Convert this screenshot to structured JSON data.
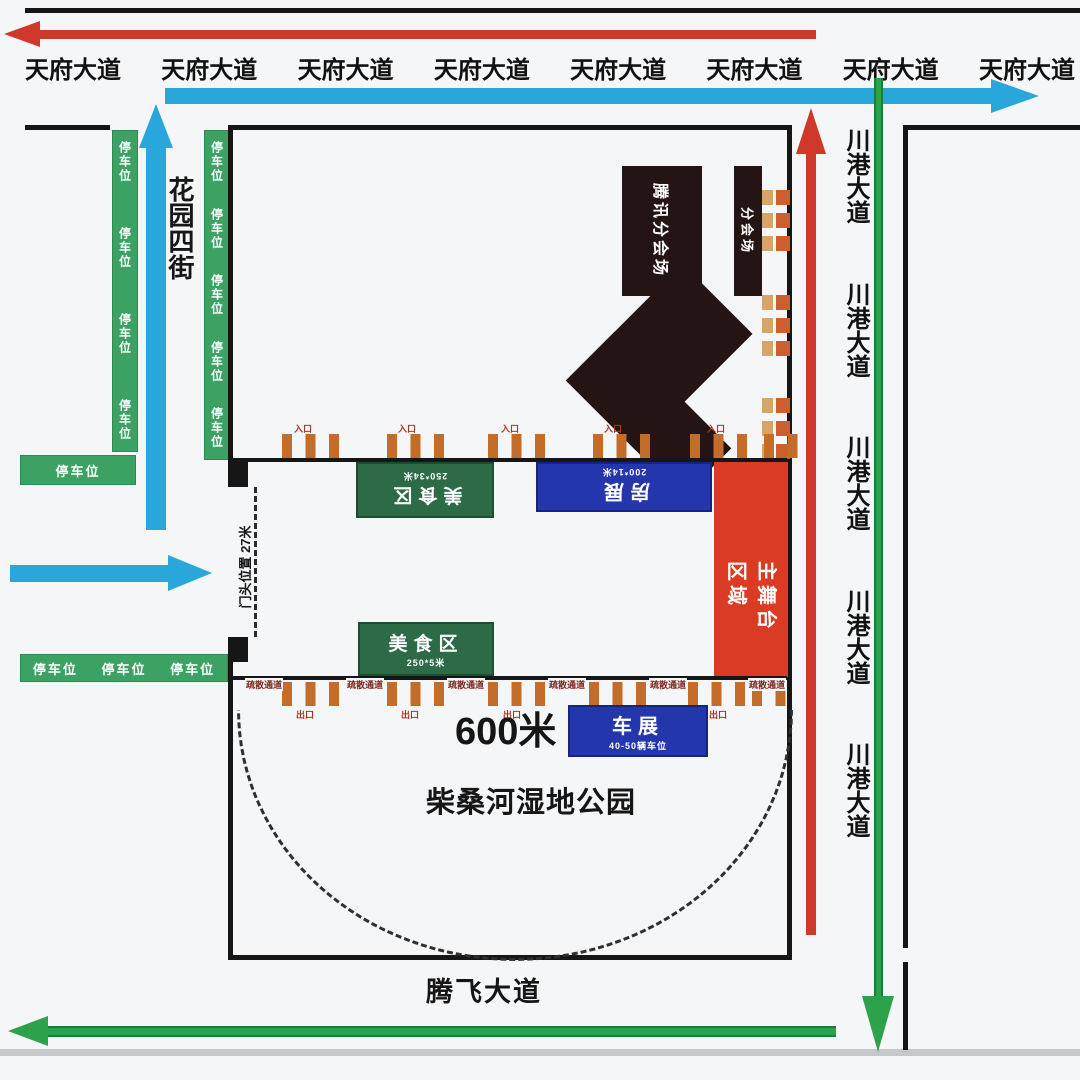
{
  "roads": {
    "tianfu_avenue": "天府大道",
    "chuangang_avenue": "川港大道",
    "huayuan_4th_street": "花园四街",
    "tengfei_avenue": "腾飞大道"
  },
  "areas": {
    "tencent_subvenue": "腾讯分会场",
    "subvenue": "分会场",
    "main_stage": "主舞台\n区域",
    "food_zone": "美食区",
    "food_zone_top_size": "250*34米",
    "food_zone_bottom_size": "250*5米",
    "housing_expo": "房展",
    "housing_expo_size": "200*14米",
    "car_expo": "车展",
    "car_expo_size": "40-50辆车位",
    "park": "柴桑河湿地公园"
  },
  "annotations": {
    "parking": "停车位",
    "entrance_width": "门头位置 27米",
    "corridor_length": "600米",
    "gate_in": "入口",
    "gate_out": "出口",
    "evac_channel": "疏散通道"
  },
  "colors": {
    "arrow_red": "#cf382b",
    "arrow_blue": "#2aa7da",
    "arrow_green": "#2ca24a",
    "strip_green": "#3ba263",
    "box_green": "#2d6b46",
    "box_blue": "#2436ac",
    "box_red": "#da3b23",
    "gate_orange": "#c46d2a",
    "line_black": "#161616"
  }
}
